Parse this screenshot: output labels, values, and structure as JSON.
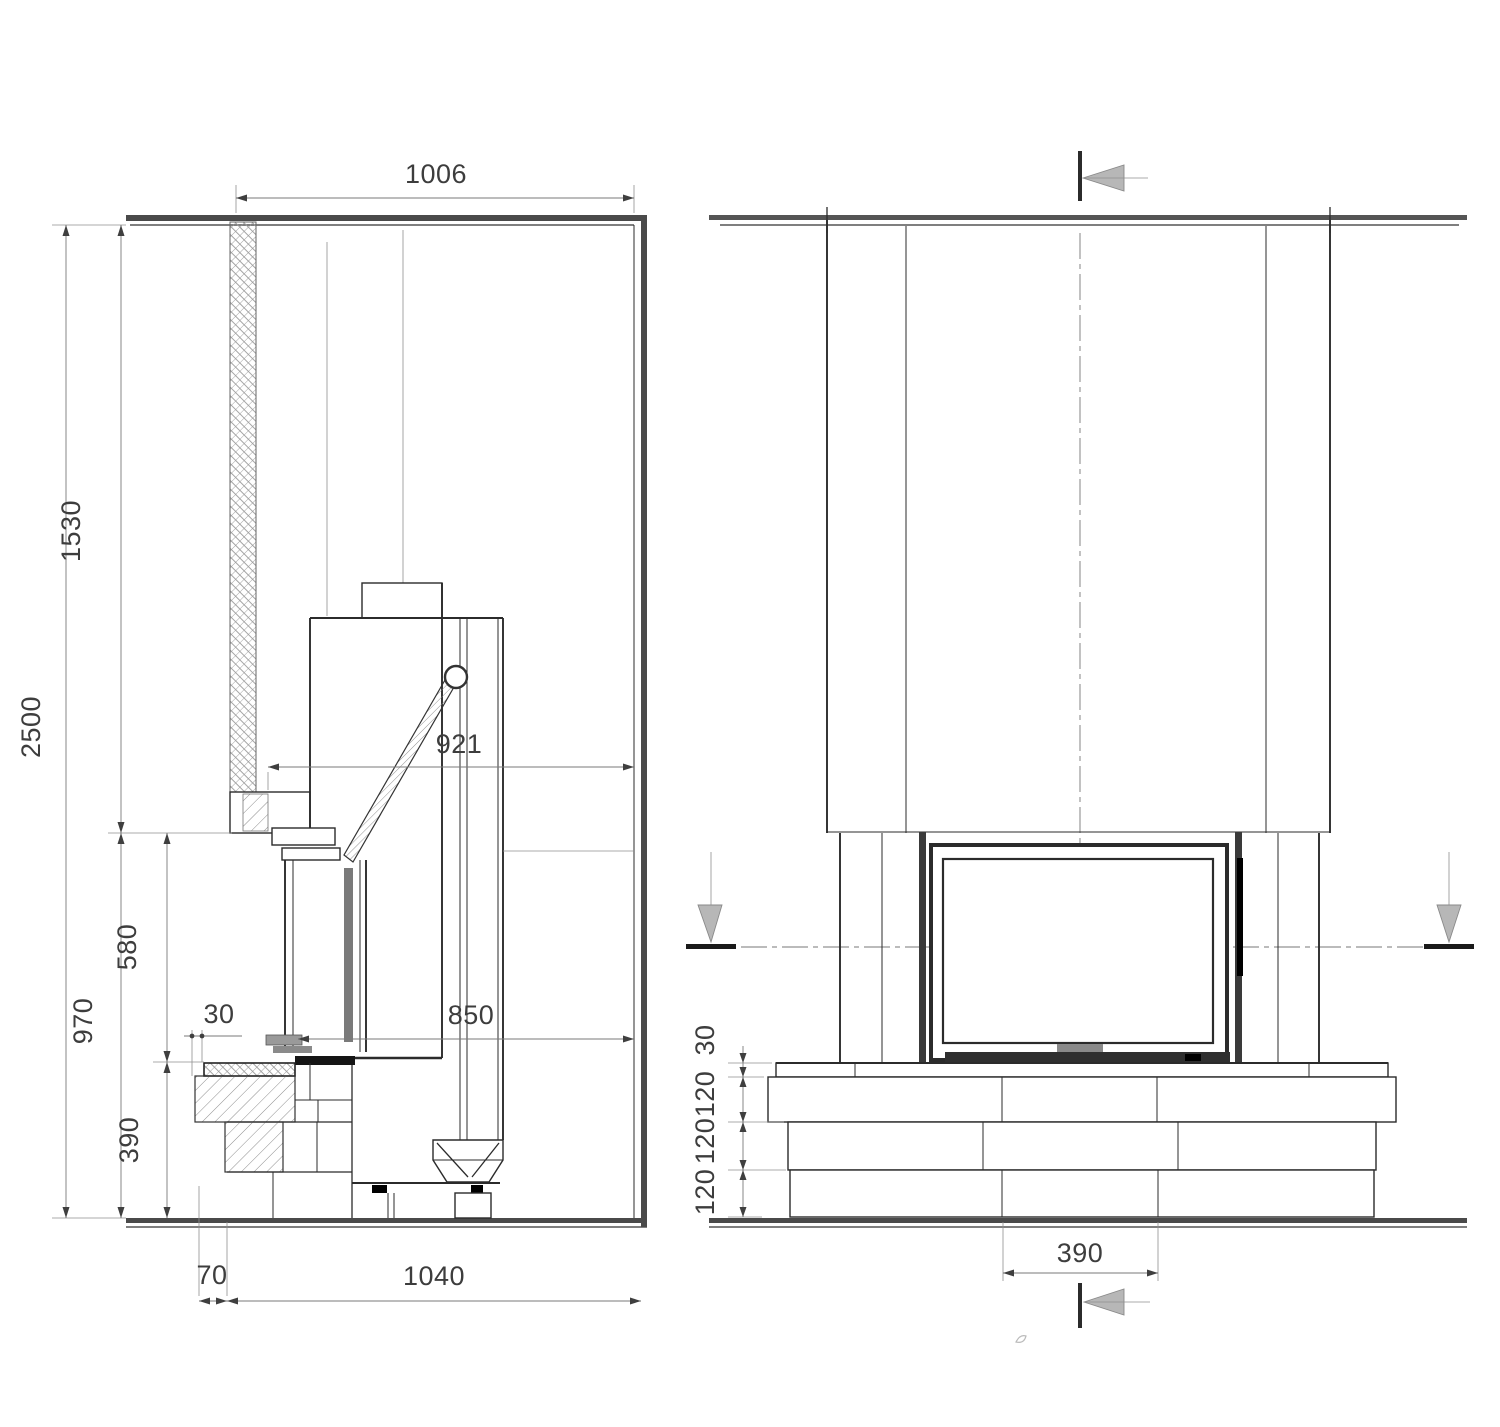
{
  "drawing": {
    "description_colors": {
      "line": "#2b2b2b",
      "dimension_line": "#7a7a7a",
      "marker_fill": "#b7b7b7",
      "glass_gray": "#7a7a7a"
    },
    "side_view": {
      "dim_top_width": "1006",
      "dim_total_height": "2500",
      "dim_upper_height": "1530",
      "dim_lower_height": "970",
      "dim_mid_height": "580",
      "dim_hearth_height": "390",
      "dim_wall_gap": "30",
      "dim_clearance_mid": "921",
      "dim_clearance_front": "850",
      "dim_hearth_offset": "70",
      "dim_base_depth": "1040"
    },
    "front_view": {
      "dim_hearth_slab": "30",
      "dim_course_top": "120",
      "dim_course_mid": "120",
      "dim_course_bottom": "120",
      "dim_plinth_width": "390"
    }
  }
}
